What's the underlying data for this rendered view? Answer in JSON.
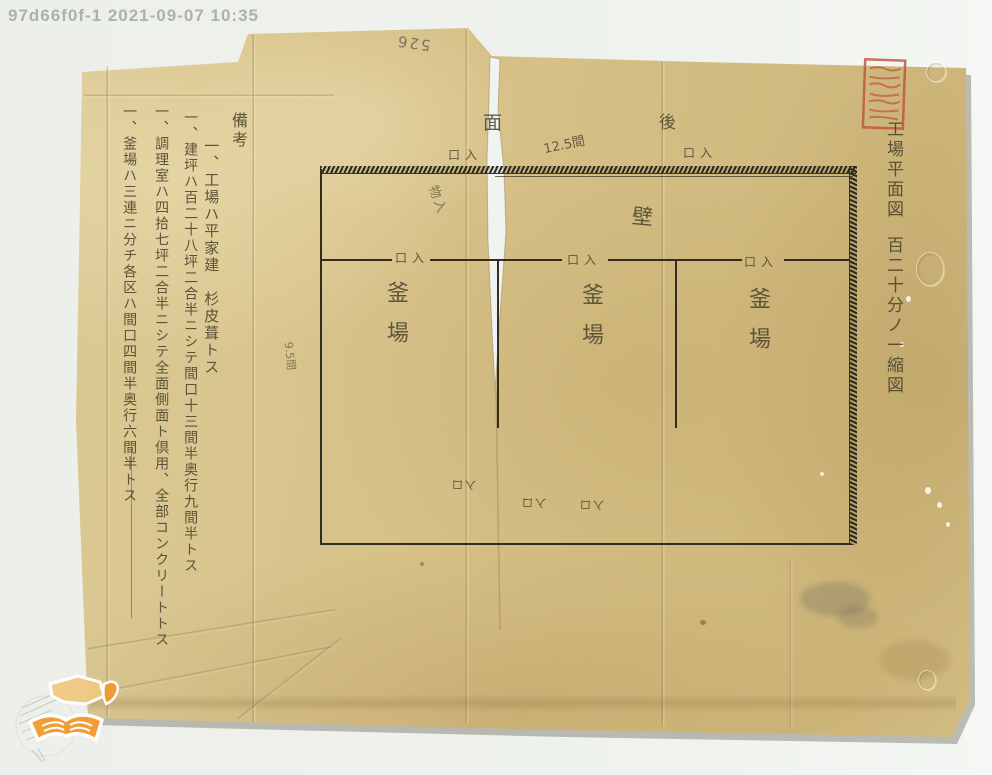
{
  "scan_overlay": {
    "timestamp": "97d66f0f-1 2021-09-07 10:35",
    "page_number_pencil": "526"
  },
  "title_block": {
    "title": "工場平面図",
    "scale": "百二十分ノ一縮図"
  },
  "notes": {
    "header": "備考",
    "items": [
      "一、工場ハ平家建　杉皮葺トス",
      "一、建坪ハ百二十八坪二合半ニシテ間口十三間半奥行九間半トス",
      "一、調理室ハ四拾七坪二合半ニシテ全面側面ト倶用、全部コンクリートトス",
      "一、釜場ハ三連ニ分チ各区ハ間口四間半奥行六間半トス"
    ]
  },
  "plan": {
    "rooms": [
      "釜場",
      "釜場",
      "釜場"
    ],
    "entrance_marks": {
      "label": "口入"
    },
    "orientation_labels": {
      "face": "面",
      "rear": "後"
    },
    "wall_label": "壁",
    "dimensions": {
      "top_width": "12.5間",
      "left_depth": "9.5間"
    },
    "small_annotations": {
      "near_tear": "物入",
      "bottom_marks": [
        "入口",
        "入口",
        "入口"
      ]
    }
  }
}
